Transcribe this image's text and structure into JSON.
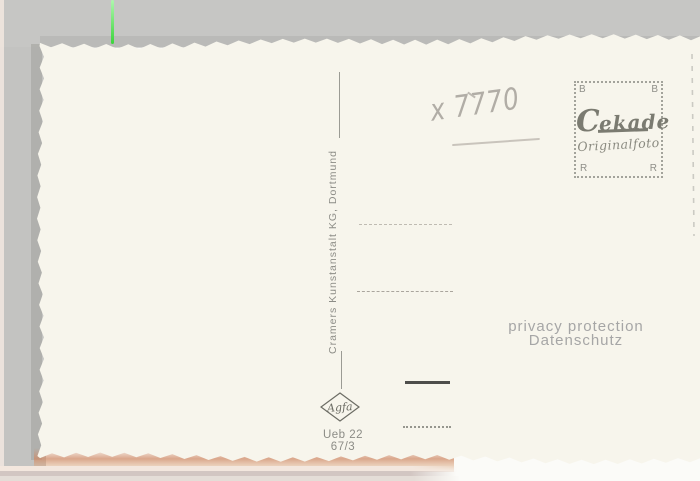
{
  "postcard": {
    "handwritten_number": "x 7770",
    "publisher_imprint": "Cramers Kunstanstalt KG, Dortmund",
    "stamp_box": {
      "corner_top_left": "B",
      "corner_top_right": "B",
      "corner_bottom_left": "R",
      "corner_bottom_right": "R",
      "brand": "Cekade",
      "subtitle": "Originalfoto"
    },
    "film_logo": "Agfa",
    "order_number": "Ueb 22",
    "series_number": "67/3"
  },
  "scan_overlay": {
    "watermark_line1": "privacy protection",
    "watermark_line2": "Datenschutz"
  },
  "colors": {
    "card_paper": "#f7f5ec",
    "scanner_background": "#c5c5c3",
    "pencil": "#b1ada6",
    "imprint_gray": "#8d8d87",
    "watermark_gray": "#a6a6a6",
    "scratch_green": "#4fdc4f",
    "bottom_edge_glow": "#cf8a66",
    "stamp_ink": "#7b7b71"
  }
}
